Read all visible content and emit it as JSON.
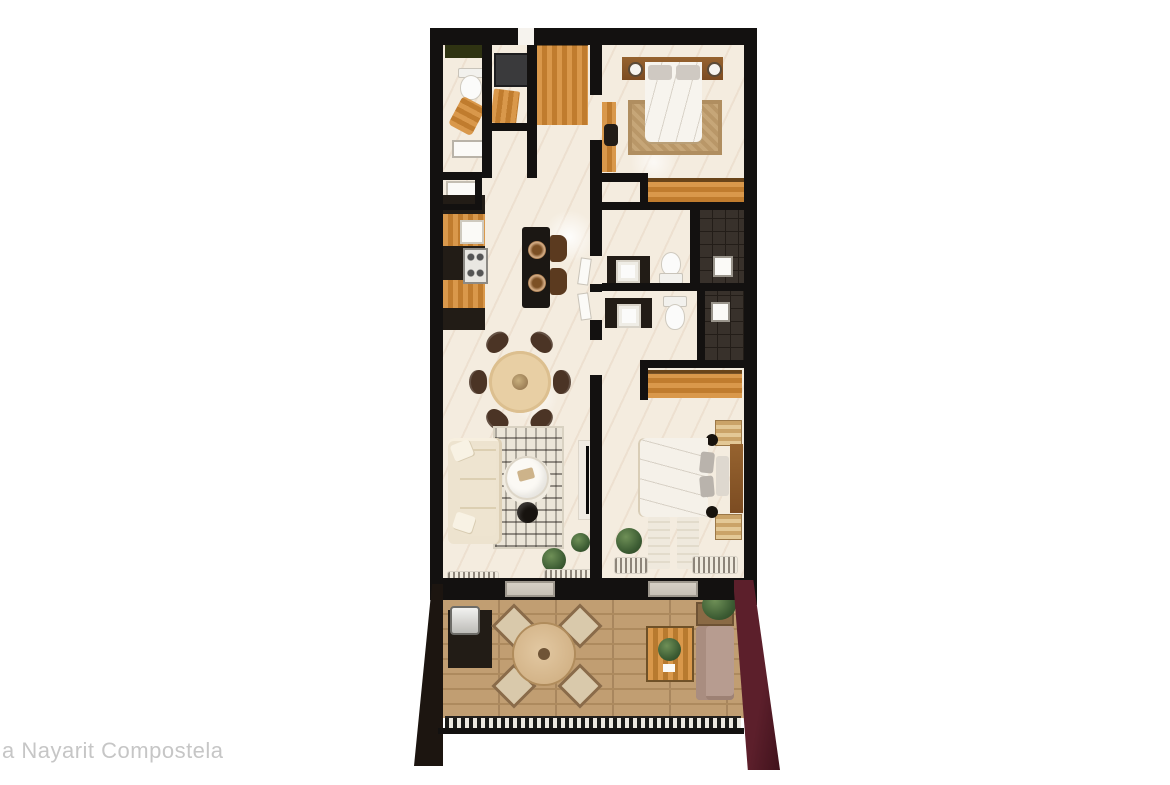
{
  "caption": {
    "text": "a Nayarit Compostela"
  },
  "floorplan": {
    "kind": "top-down 3D apartment floor-plan rendering",
    "summary": {
      "bedrooms": 2,
      "bathrooms": 2,
      "powder_laundry": 1,
      "terrace": 1
    },
    "rooms": [
      "powder-laundry-room",
      "closet",
      "pantry",
      "kitchen",
      "dining-area",
      "living-room",
      "main-bedroom",
      "ensuite-bathroom",
      "second-bathroom",
      "second-bedroom",
      "hallway",
      "terrace"
    ],
    "furniture": [
      "toilet",
      "washer",
      "kitchen-counter-with-stove",
      "kitchen-island-with-stools",
      "round-dining-table-6-chairs",
      "l-shaped-sofa",
      "boho-rug",
      "coffee-table",
      "tv-console",
      "double-bed-1",
      "double-bed-2",
      "wardrobes",
      "vanities",
      "showers",
      "outdoor-dining-set",
      "outdoor-sofa",
      "grill-counter",
      "plants"
    ],
    "palette": {
      "background": "#ffffff",
      "walls": "#131110",
      "marble_floor": "#f4ecdf",
      "light_wood": "#d28f42",
      "dark_wood": "#8a5832",
      "black_counter": "#221c16",
      "deck_wood": "#c19e72",
      "maroon_accent": "#5c1f2b",
      "plant_green": "#3f5f33",
      "sofa_cream": "#ede3cf",
      "caption_gray": "#c6c6c6"
    }
  }
}
